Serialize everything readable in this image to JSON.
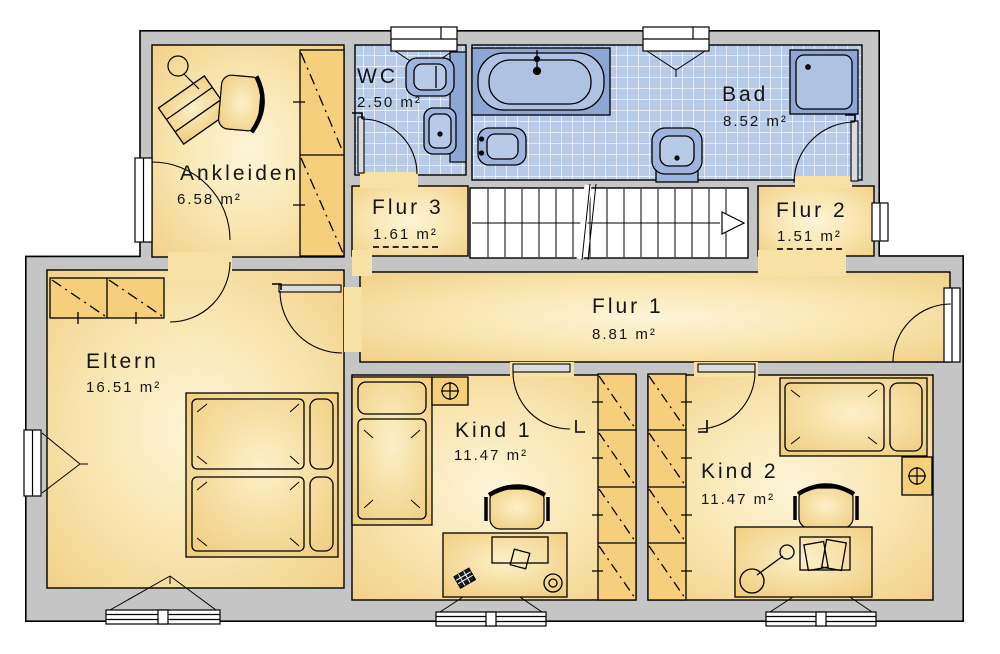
{
  "rooms": {
    "ankleiden": {
      "name": "Ankleiden",
      "area": "6.58 m²"
    },
    "wc": {
      "name": "WC",
      "area": "2.50 m²"
    },
    "bad": {
      "name": "Bad",
      "area": "8.52 m²"
    },
    "flur3": {
      "name": "Flur 3",
      "area": "1.61 m²"
    },
    "flur2": {
      "name": "Flur 2",
      "area": "1.51 m²"
    },
    "flur1": {
      "name": "Flur 1",
      "area": "8.81 m²"
    },
    "eltern": {
      "name": "Eltern",
      "area": "16.51 m²"
    },
    "kind1": {
      "name": "Kind 1",
      "area": "11.47 m²"
    },
    "kind2": {
      "name": "Kind 2",
      "area": "11.47 m²"
    }
  },
  "colors": {
    "wall": "#c5c5c5",
    "outline": "#000000",
    "floor_edge": "#f0cd82",
    "floor_center": "#fdf5d8",
    "tile": "#b7cbe8",
    "tile_grid": "#ffffff",
    "fixture": "#9db4dc",
    "fixture_dark": "#8ca7d4",
    "fixture_light": "#b7cbe8",
    "stairs": "#ffffff"
  },
  "icons": {
    "stair_direction": "right-open-triangle",
    "plant_on_table": "circle-crosshair",
    "wardrobe_mark": "dash-dot-diagonal"
  }
}
